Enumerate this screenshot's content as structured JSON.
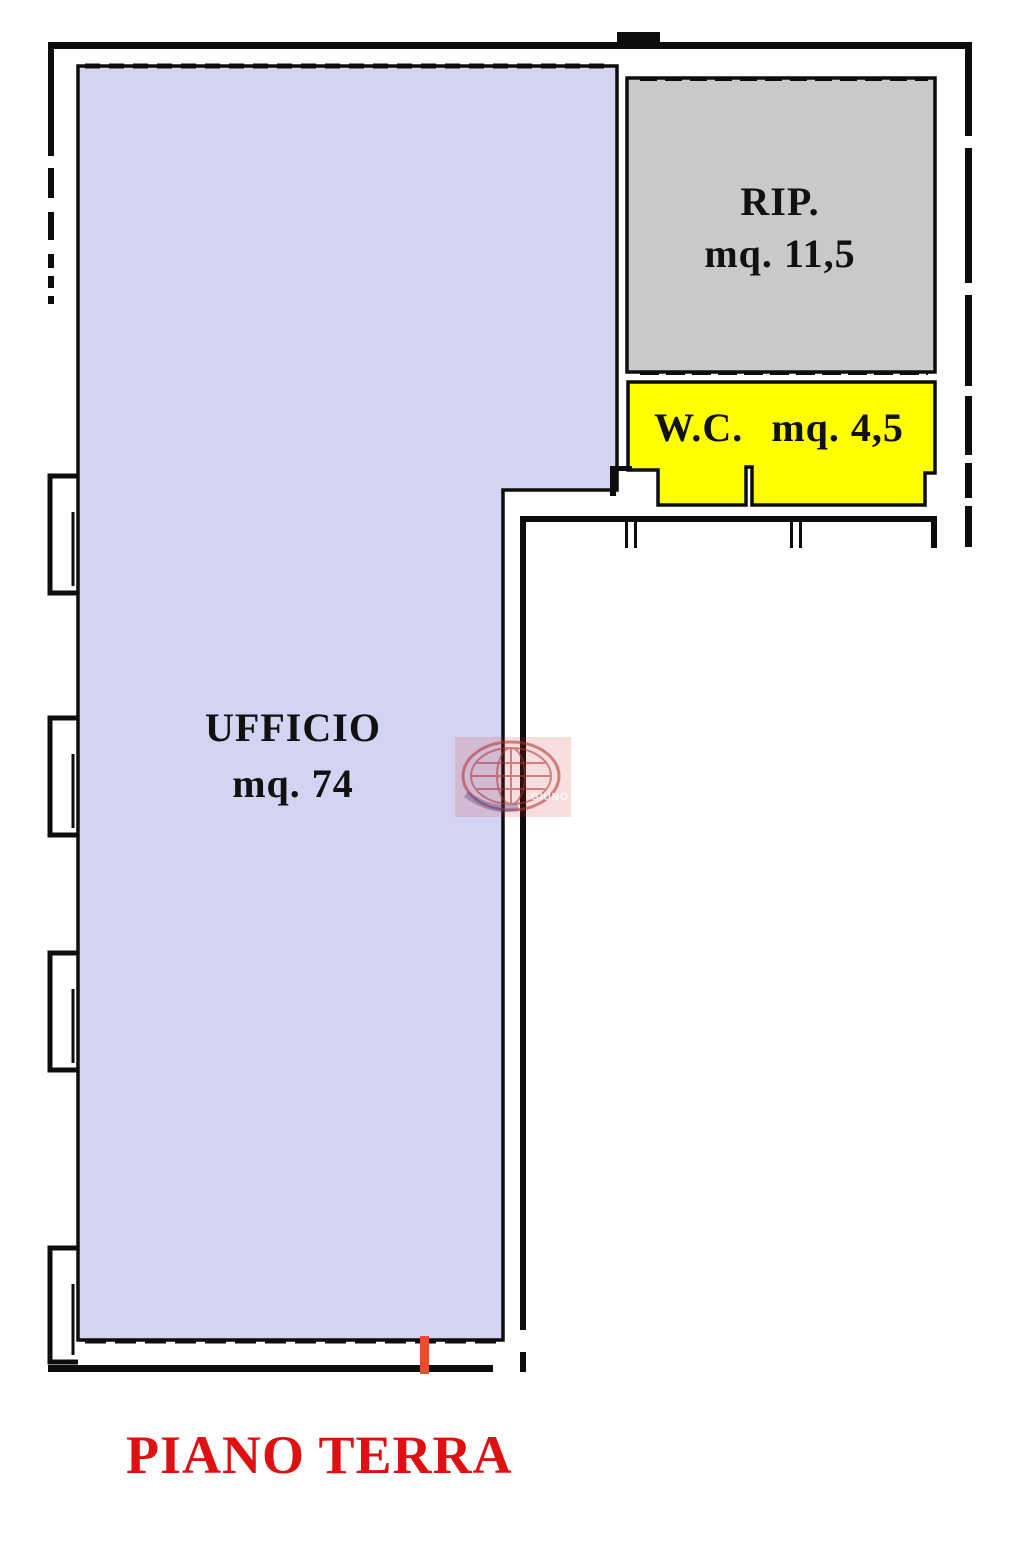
{
  "title": "PIANO TERRA",
  "title_color": "#dd1111",
  "rooms": [
    {
      "id": "ufficio",
      "label": "UFFICIO",
      "area": "mq. 74",
      "color": "#d4d4f2"
    },
    {
      "id": "rip",
      "label": "RIP.",
      "area": "mq. 11,5",
      "color": "#c9c9c9"
    },
    {
      "id": "wc",
      "label": "W.C.",
      "area": "mq. 4,5",
      "color": "#ffff00"
    }
  ],
  "door_marker": {
    "color": "#e0522c"
  },
  "watermark": {
    "text": "GIUNO",
    "color": "#b23030"
  },
  "wall_color": "#0d0d0d"
}
